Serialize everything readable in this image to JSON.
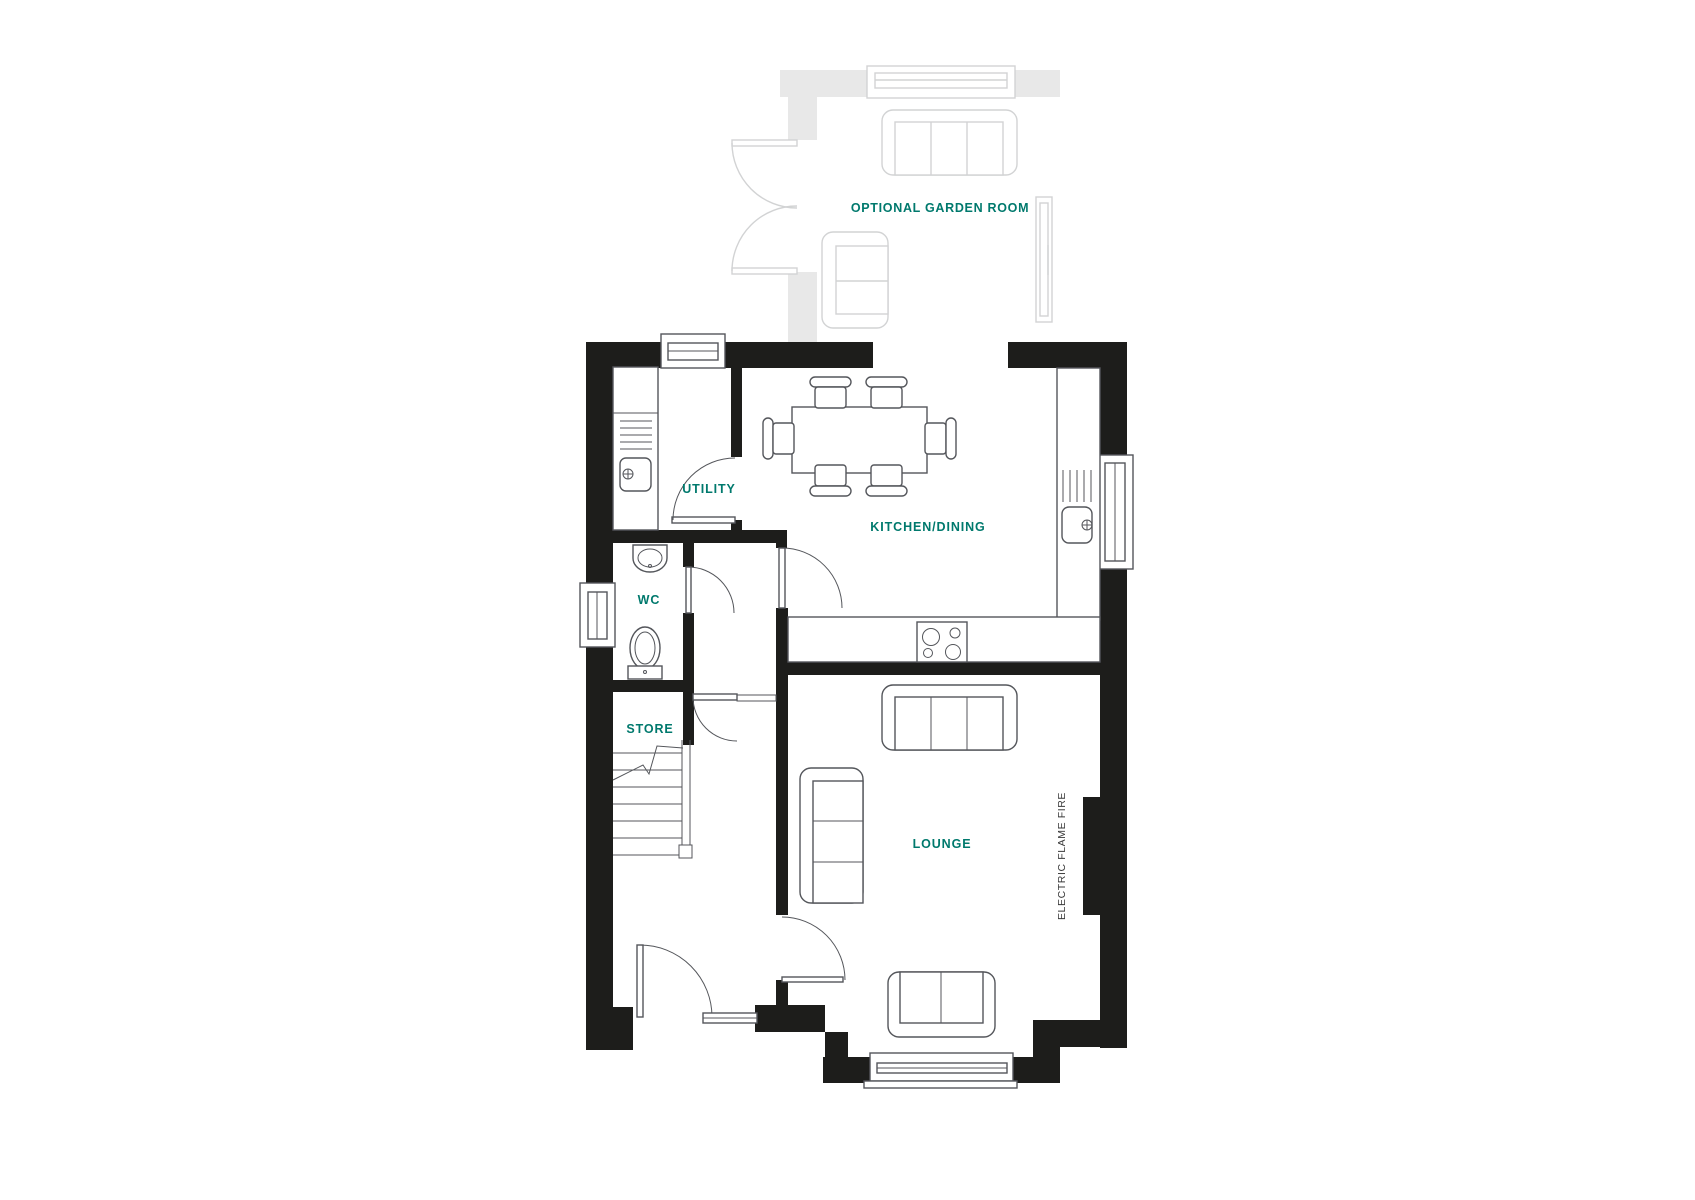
{
  "labels": {
    "garden_room": "OPTIONAL GARDEN ROOM",
    "utility": "UTILITY",
    "kitchen_dining": "KITCHEN/DINING",
    "wc": "WC",
    "store": "STORE",
    "lounge": "LOUNGE",
    "fire": "ELECTRIC FLAME FIRE"
  },
  "colors": {
    "label-teal": "#00796d",
    "wall-black": "#1d1d1b",
    "line-gray": "#54565b",
    "optional-wall": "#e8e8e8",
    "optional-line": "#d2d3d4",
    "fire-text": "#3a3a3a",
    "background": "#ffffff"
  }
}
